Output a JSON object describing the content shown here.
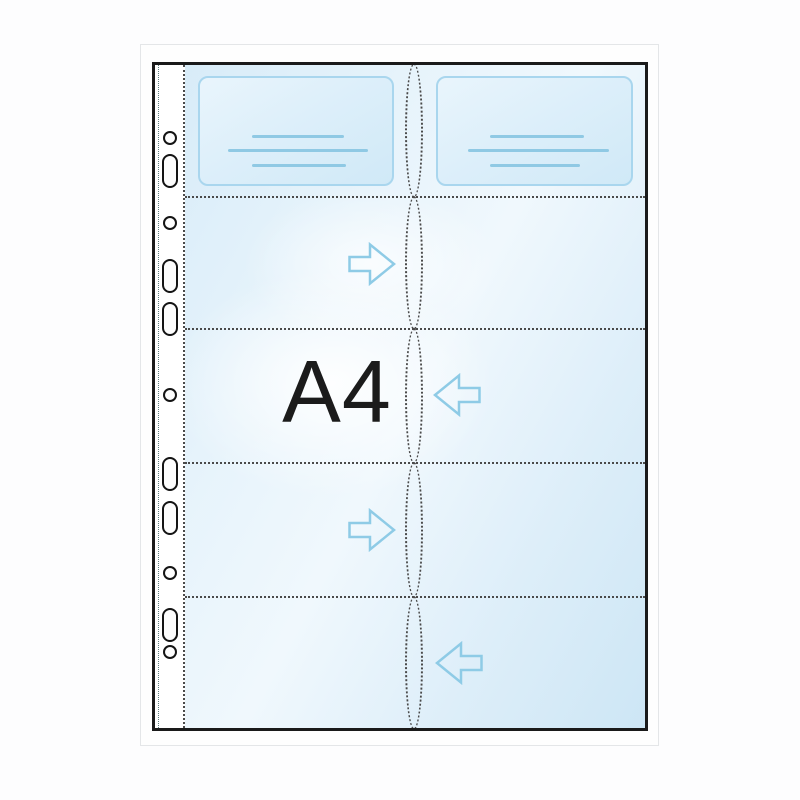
{
  "illustration": {
    "label": "A4",
    "description_icons": [
      "insert-arrow-right-icon",
      "insert-arrow-left-icon"
    ],
    "colors": {
      "sheet_border": "#1a1a1a",
      "dotted_line": "#4a4a4a",
      "accent_blue": "#8ecbe6",
      "card_border": "#a9d6ee",
      "card_fill": "#ddeffa",
      "pocket_tint": "#d6ebf8",
      "hole_border": "#141414",
      "frame_border": "#e4e6e8",
      "label_color": "#1b1b1b"
    },
    "grid": {
      "rows": 5,
      "columns": 2
    }
  },
  "holes": [
    {
      "type": "circle",
      "cy": 73
    },
    {
      "type": "oblong",
      "cy": 106
    },
    {
      "type": "circle",
      "cy": 158
    },
    {
      "type": "oblong",
      "cy": 211
    },
    {
      "type": "oblong",
      "cy": 254
    },
    {
      "type": "circle",
      "cy": 330
    },
    {
      "type": "oblong",
      "cy": 409
    },
    {
      "type": "oblong",
      "cy": 453
    },
    {
      "type": "circle",
      "cy": 508
    },
    {
      "type": "oblong",
      "cy": 560
    },
    {
      "type": "circle",
      "cy": 587
    }
  ],
  "row_lines": [
    131,
    263,
    397,
    531
  ],
  "slits": [
    {
      "top": -2,
      "height": 135
    },
    {
      "top": 131,
      "height": 134
    },
    {
      "top": 263,
      "height": 136
    },
    {
      "top": 397,
      "height": 136
    },
    {
      "top": 531,
      "height": 134
    }
  ],
  "cards": [
    {
      "left": 43,
      "top": 11,
      "width": 196,
      "height": 110,
      "lines": [
        {
          "top": 57,
          "left": 52,
          "width": 92
        },
        {
          "top": 71,
          "left": 28,
          "width": 140
        },
        {
          "top": 86,
          "left": 52,
          "width": 94
        }
      ]
    },
    {
      "left": 281,
      "top": 11,
      "width": 197,
      "height": 110,
      "lines": [
        {
          "top": 57,
          "left": 52,
          "width": 94
        },
        {
          "top": 71,
          "left": 30,
          "width": 141
        },
        {
          "top": 86,
          "left": 52,
          "width": 90
        }
      ]
    }
  ],
  "arrows": [
    {
      "dir": "right",
      "left": 193,
      "top": 177
    },
    {
      "dir": "left",
      "left": 278,
      "top": 308
    },
    {
      "dir": "right",
      "left": 193,
      "top": 443
    },
    {
      "dir": "left",
      "left": 280,
      "top": 576
    }
  ]
}
